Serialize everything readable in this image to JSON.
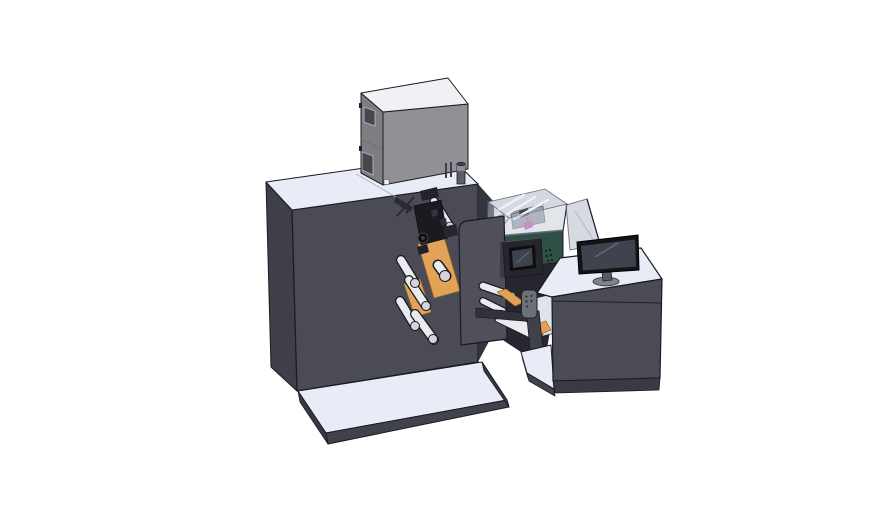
{
  "scene": {
    "description": "Isometric 3D CAD render of an industrial label printing and rewinding line: a large dark cabinet with a gray marking unit and small canister on its white top deck, a print-head assembly with white web rollers and an orange label web behind a front cover plate, a dark-teal inspection conveyor with a transparent hood and black HMI touchscreen, a hanging control pendant, and an operator desk cabinet with a desktop monitor and a safety glass panel, all standing on white base platforms over a white background.",
    "background": "#ffffff"
  },
  "colors": {
    "bg": "#ffffff",
    "ink": "#1a1a20",
    "surface": "#e8ecf7",
    "cab-front": "#4b4b55",
    "cab-left": "#3f3f49",
    "cab-side": "#34343e",
    "plate": "#50505a",
    "plinth-front": "#42424c",
    "plinth-side": "#383842",
    "box-front": "#919195",
    "box-left": "#7e7e82",
    "box-top": "#f0f1f4",
    "box-window": "#46464e",
    "roller": "#eaebef",
    "roller-cap": "#d3d4da",
    "orange": "#e2a257",
    "green-front": "#2e5147",
    "green-side": "#203b33",
    "glass": "#c7ccd6",
    "hood-inner": "#d4d8e1",
    "strut": "#eef0f5",
    "magenta": "#b85bb2",
    "dark-zone": "#26262e",
    "hmi-body": "#26262c",
    "screen": "#3f434e",
    "pendant": "#6f6f77",
    "monitor-bezel": "#131318",
    "stand": "#565a64",
    "monitor-base": "#7e828c",
    "beam": "#32323b",
    "white-panel": "#dfe3ee",
    "leg": "#40404a",
    "skirt": "#3a3a44",
    "gray-mech": "#9aa0ab"
  },
  "components": [
    {
      "id": "main-cabinet",
      "label": "Main machine cabinet"
    },
    {
      "id": "marking-unit",
      "label": "Gray marking unit"
    },
    {
      "id": "canister",
      "label": "Small canister"
    },
    {
      "id": "print-head",
      "label": "Print head assembly"
    },
    {
      "id": "web-rollers",
      "label": "Web guide rollers"
    },
    {
      "id": "label-web",
      "label": "Orange label web"
    },
    {
      "id": "front-plate",
      "label": "Front cover plate"
    },
    {
      "id": "inspection-unit",
      "label": "Teal inspection conveyor"
    },
    {
      "id": "clear-hood",
      "label": "Transparent hood"
    },
    {
      "id": "hmi-panel",
      "label": "HMI touchscreen"
    },
    {
      "id": "control-pendant",
      "label": "Handheld control pendant"
    },
    {
      "id": "operator-desk",
      "label": "Operator desk cabinet"
    },
    {
      "id": "monitor",
      "label": "Desktop monitor"
    },
    {
      "id": "safety-glass",
      "label": "Safety glass panel"
    },
    {
      "id": "base-platform",
      "label": "Machine base platform"
    },
    {
      "id": "desk-platform",
      "label": "Desk base platform"
    }
  ]
}
